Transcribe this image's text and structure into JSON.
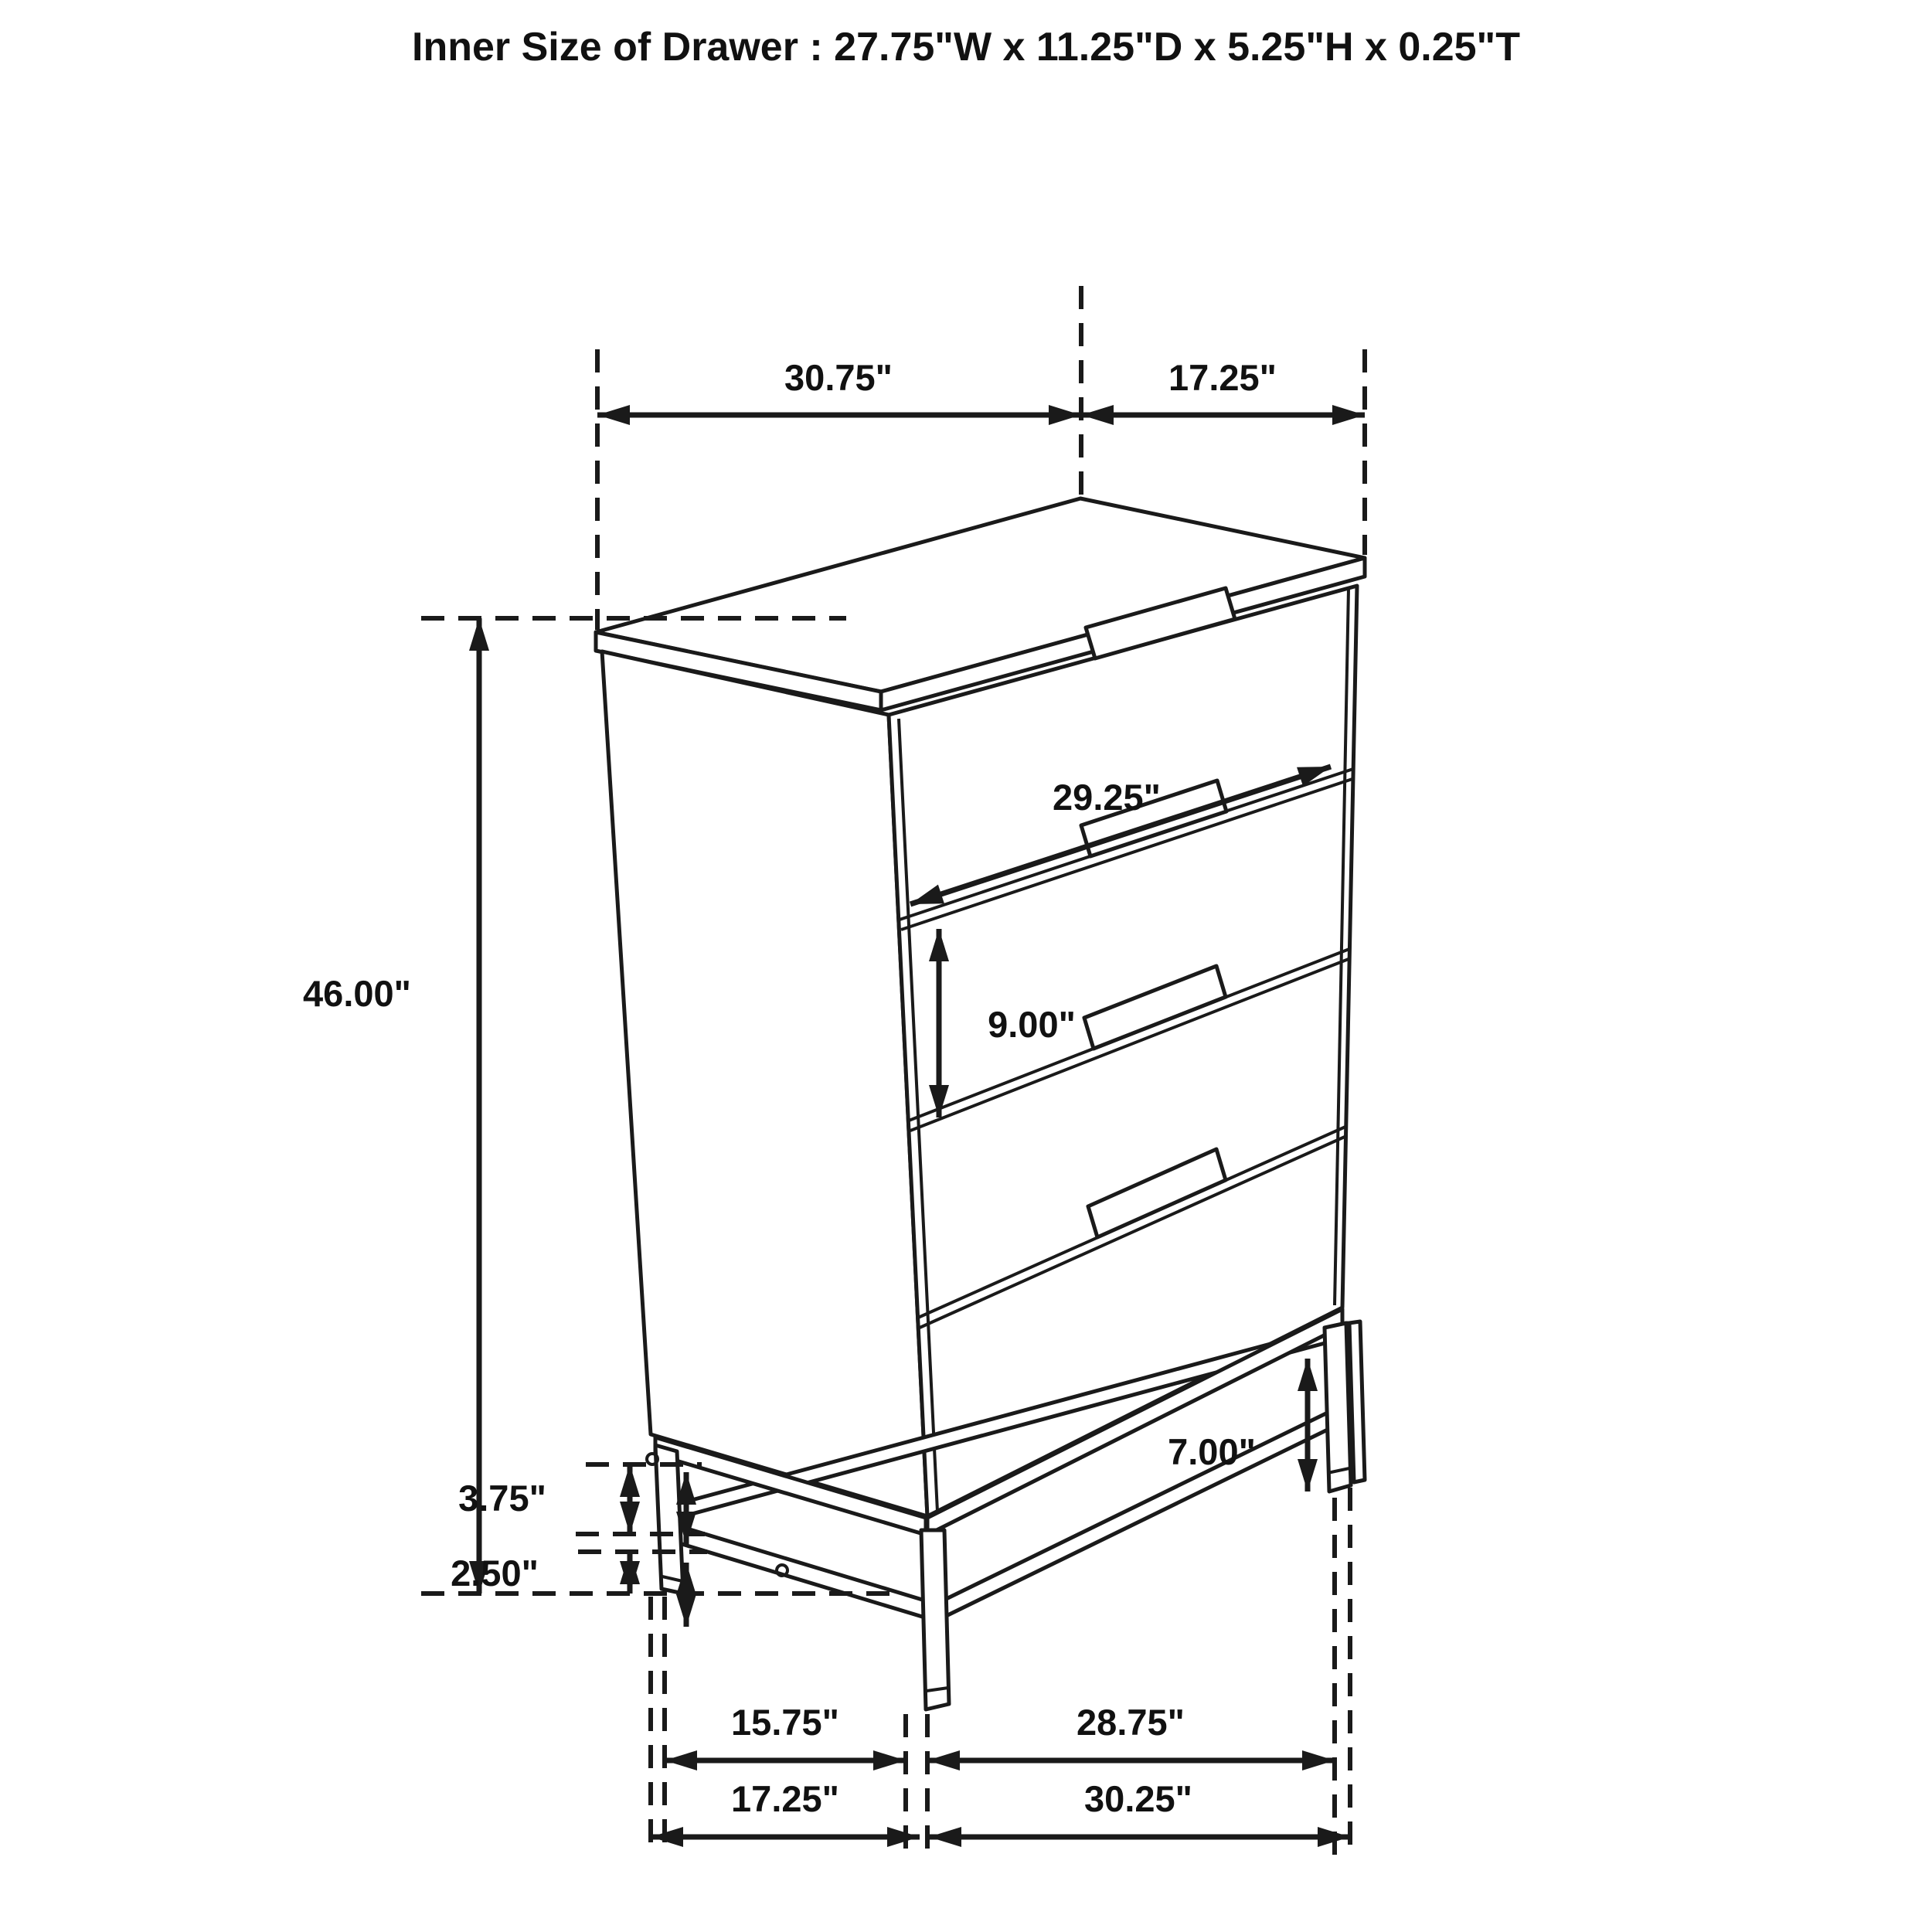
{
  "title": "Inner Size of Drawer : 27.75\"W x 11.25\"D x 5.25\"H x 0.25\"T",
  "dimensions": {
    "top_width": "30.75\"",
    "top_depth": "17.25\"",
    "drawer_face_width": "29.25\"",
    "drawer_face_height": "9.00\"",
    "overall_height": "46.00\"",
    "base_rail_height": "3.75\"",
    "base_stretcher_height": "2.50\"",
    "leg_height": "7.00\"",
    "base_inner_depth": "15.75\"",
    "base_inner_width": "28.75\"",
    "base_outer_depth": "17.25\"",
    "base_outer_width": "30.25\""
  },
  "colors": {
    "line": "#1a1a1a",
    "text": "#111111",
    "background": "#ffffff"
  }
}
